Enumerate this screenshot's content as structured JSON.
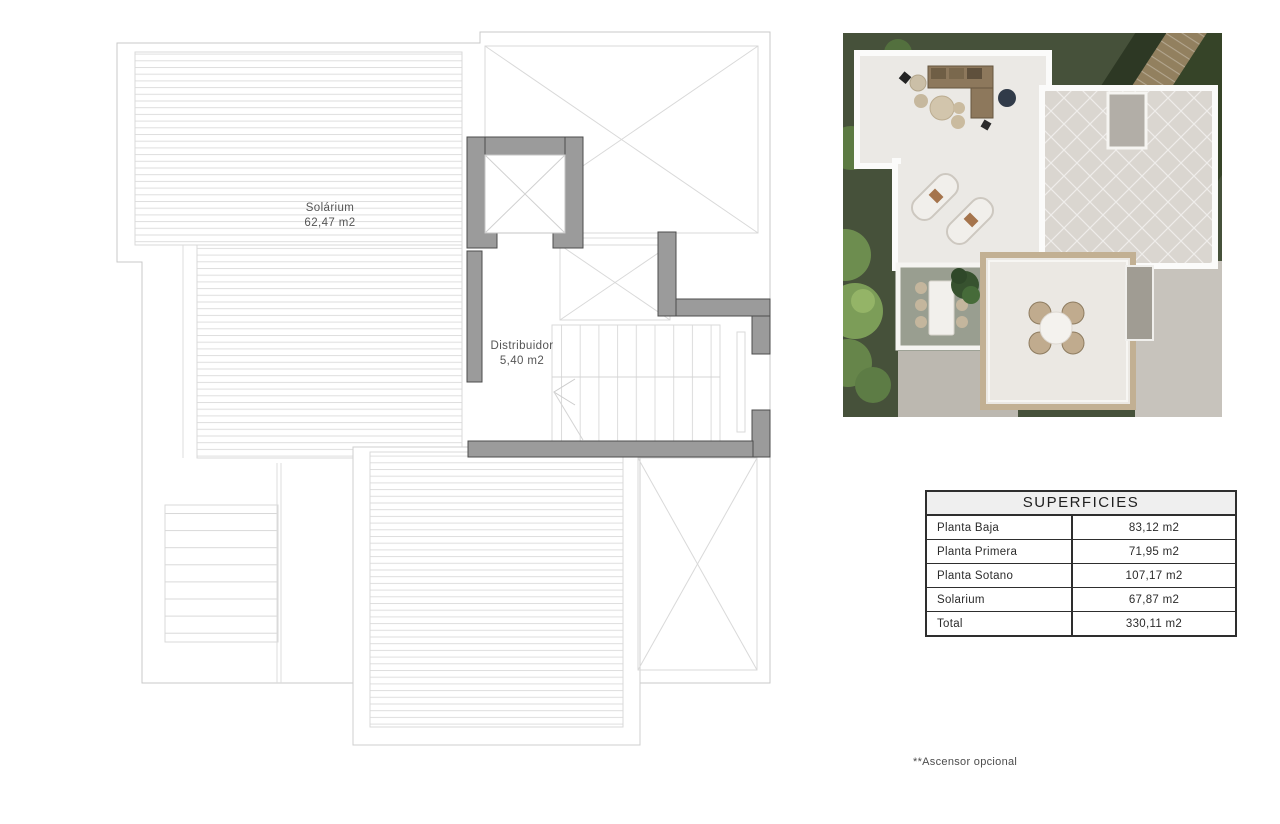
{
  "plan": {
    "rooms": [
      {
        "name": "Solárium",
        "area": "62,47 m2"
      },
      {
        "name": "Distribuidor",
        "area": "5,40 m2"
      }
    ],
    "colors": {
      "wall_fill": "#9b9b9b",
      "wall_outline": "#4d4d4d",
      "thin_line": "#d6d6d6",
      "label_text": "#555555"
    }
  },
  "render": {
    "colors": {
      "garden": "#46513a",
      "bush": "#7c9d58",
      "terrace_floor": "#ebe9e5",
      "parapet": "#fbfbfa",
      "tiles": "#dad6d0",
      "mosaic_border": "#c2b093",
      "sofa": "#8d785c",
      "path": "#92805f",
      "concrete": "#c7c3bc"
    }
  },
  "superficies": {
    "title": "SUPERFICIES",
    "rows": [
      {
        "label": "Planta Baja",
        "value": "83,12 m2"
      },
      {
        "label": "Planta Primera",
        "value": "71,95 m2"
      },
      {
        "label": "Planta Sotano",
        "value": "107,17 m2"
      },
      {
        "label": "Solarium",
        "value": "67,87 m2"
      },
      {
        "label": "Total",
        "value": "330,11 m2"
      }
    ]
  },
  "footnote": "**Ascensor opcional"
}
